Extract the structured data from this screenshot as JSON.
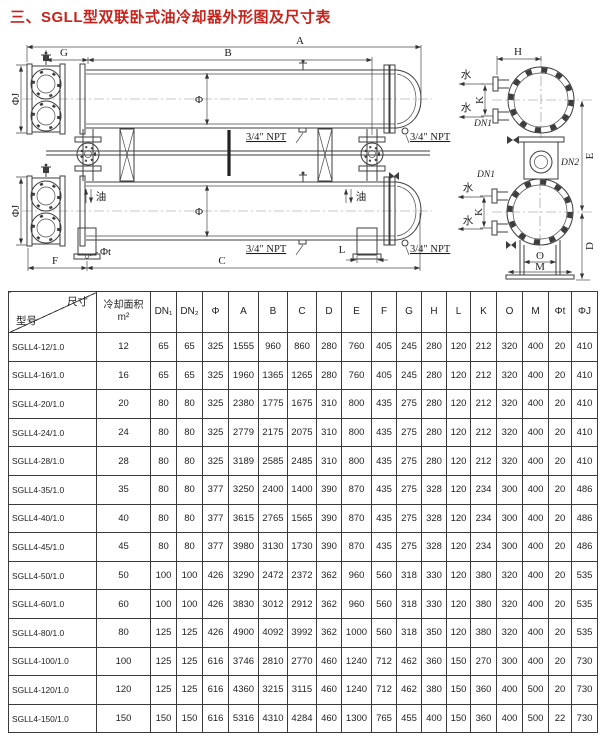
{
  "title": "三、SGLL型双联卧式油冷却器外形图及尺寸表",
  "diagram": {
    "labels": {
      "A": "A",
      "B": "B",
      "C": "C",
      "D": "D",
      "E": "E",
      "F": "F",
      "G": "G",
      "H": "H",
      "K": "K",
      "L": "L",
      "M": "M",
      "O": "O",
      "phi": "Φ",
      "phi_j": "ΦJ",
      "phi_t": "Φt",
      "npt": "3/4″ NPT",
      "water": "水",
      "oil": "油",
      "dn1": "DN1",
      "dn2": "DN2"
    }
  },
  "table": {
    "corner": {
      "top": "尺寸",
      "bottom": "型号"
    },
    "area_header": {
      "line1": "冷却面积",
      "line2": "m²"
    },
    "columns": [
      "DN₁",
      "DN₂",
      "Φ",
      "A",
      "B",
      "C",
      "D",
      "E",
      "F",
      "G",
      "H",
      "L",
      "K",
      "O",
      "M",
      "Φt",
      "ΦJ"
    ],
    "rows": [
      {
        "model": "SGLL4-12/1.0",
        "values": [
          12,
          65,
          65,
          325,
          1555,
          960,
          860,
          280,
          760,
          405,
          245,
          280,
          120,
          212,
          320,
          400,
          20,
          410
        ]
      },
      {
        "model": "SGLL4-16/1.0",
        "values": [
          16,
          65,
          65,
          325,
          1960,
          1365,
          1265,
          280,
          760,
          405,
          245,
          280,
          120,
          212,
          320,
          400,
          20,
          410
        ]
      },
      {
        "model": "SGLL4-20/1.0",
        "values": [
          20,
          80,
          80,
          325,
          2380,
          1775,
          1675,
          310,
          800,
          435,
          275,
          280,
          120,
          212,
          320,
          400,
          20,
          410
        ]
      },
      {
        "model": "SGLL4-24/1.0",
        "values": [
          24,
          80,
          80,
          325,
          2779,
          2175,
          2075,
          310,
          800,
          435,
          275,
          280,
          120,
          212,
          320,
          400,
          20,
          410
        ]
      },
      {
        "model": "SGLL4-28/1.0",
        "values": [
          28,
          80,
          80,
          325,
          3189,
          2585,
          2485,
          310,
          800,
          435,
          275,
          280,
          120,
          212,
          320,
          400,
          20,
          410
        ]
      },
      {
        "model": "SGLL4-35/1.0",
        "values": [
          35,
          80,
          80,
          377,
          3250,
          2400,
          1400,
          390,
          870,
          435,
          275,
          328,
          120,
          234,
          300,
          400,
          20,
          486
        ]
      },
      {
        "model": "SGLL4-40/1.0",
        "values": [
          40,
          80,
          80,
          377,
          3615,
          2765,
          1565,
          390,
          870,
          435,
          275,
          328,
          120,
          234,
          300,
          400,
          20,
          486
        ]
      },
      {
        "model": "SGLL4-45/1.0",
        "values": [
          45,
          80,
          80,
          377,
          3980,
          3130,
          1730,
          390,
          870,
          435,
          275,
          328,
          120,
          234,
          300,
          400,
          20,
          486
        ]
      },
      {
        "model": "SGLL4-50/1.0",
        "values": [
          50,
          100,
          100,
          426,
          3290,
          2472,
          2372,
          362,
          960,
          560,
          318,
          330,
          120,
          380,
          320,
          400,
          20,
          535
        ]
      },
      {
        "model": "SGLL4-60/1.0",
        "values": [
          60,
          100,
          100,
          426,
          3830,
          3012,
          2912,
          362,
          960,
          560,
          318,
          330,
          120,
          380,
          320,
          400,
          20,
          535
        ]
      },
      {
        "model": "SGLL4-80/1.0",
        "values": [
          80,
          125,
          125,
          426,
          4900,
          4092,
          3992,
          362,
          1000,
          560,
          318,
          350,
          120,
          380,
          320,
          400,
          20,
          535
        ]
      },
      {
        "model": "SGLL4-100/1.0",
        "values": [
          100,
          125,
          125,
          616,
          3746,
          2810,
          2770,
          460,
          1240,
          712,
          462,
          360,
          150,
          270,
          300,
          400,
          20,
          730
        ]
      },
      {
        "model": "SGLL4-120/1.0",
        "values": [
          120,
          125,
          125,
          616,
          4360,
          3215,
          3115,
          460,
          1240,
          712,
          462,
          380,
          150,
          360,
          400,
          500,
          20,
          730
        ]
      },
      {
        "model": "SGLL4-150/1.0",
        "values": [
          150,
          150,
          150,
          616,
          5316,
          4310,
          4284,
          460,
          1300,
          765,
          455,
          400,
          150,
          360,
          400,
          500,
          22,
          730
        ]
      }
    ]
  }
}
